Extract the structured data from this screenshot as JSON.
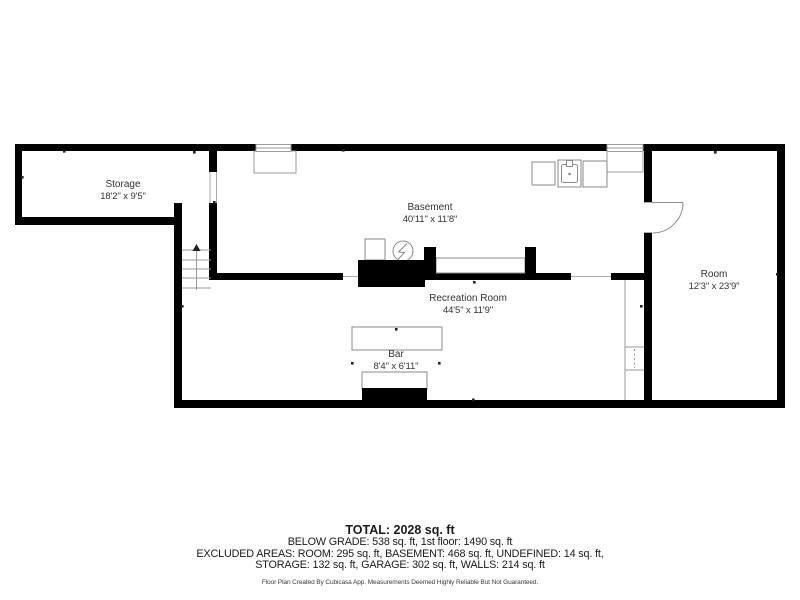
{
  "floor_plan": {
    "rooms": [
      {
        "name": "Storage",
        "dimensions": "18'2\" x 9'5\""
      },
      {
        "name": "Basement",
        "dimensions": "40'11\" x 11'8\""
      },
      {
        "name": "Recreation Room",
        "dimensions": "44'5\" x 11'9\""
      },
      {
        "name": "Bar",
        "dimensions": "8'4\" x 6'11\""
      },
      {
        "name": "Room",
        "dimensions": "12'3\" x 23'9\""
      }
    ],
    "symbols": [
      "staircase-with-up-arrow",
      "door-swing-arc",
      "window-with-well",
      "sink-icon",
      "appliance-square",
      "water-heater-circle-zigzag",
      "chimney-block",
      "bar-counter",
      "closet-shelf-dotted",
      "dimension-tick"
    ]
  },
  "summary": {
    "total": "TOTAL: 2028 sq. ft",
    "below_grade_line": "BELOW GRADE: 538 sq. ft, 1st floor: 1490 sq. ft",
    "excluded_line_1": "EXCLUDED AREAS: ROOM: 295 sq. ft, BASEMENT: 468 sq. ft, UNDEFINED: 14 sq. ft,",
    "excluded_line_2": "STORAGE: 132 sq. ft, GARAGE: 302 sq. ft, WALLS: 214 sq. ft",
    "disclaimer": "Floor Plan Created By Cubicasa App. Measurements Deemed Highly Reliable But Not Guaranteed."
  },
  "colors": {
    "background": "#ffffff",
    "wall": "#000000",
    "fixture_line": "#8a8a8a",
    "label_text": "#333333",
    "summary_text": "#1a1a1a"
  }
}
